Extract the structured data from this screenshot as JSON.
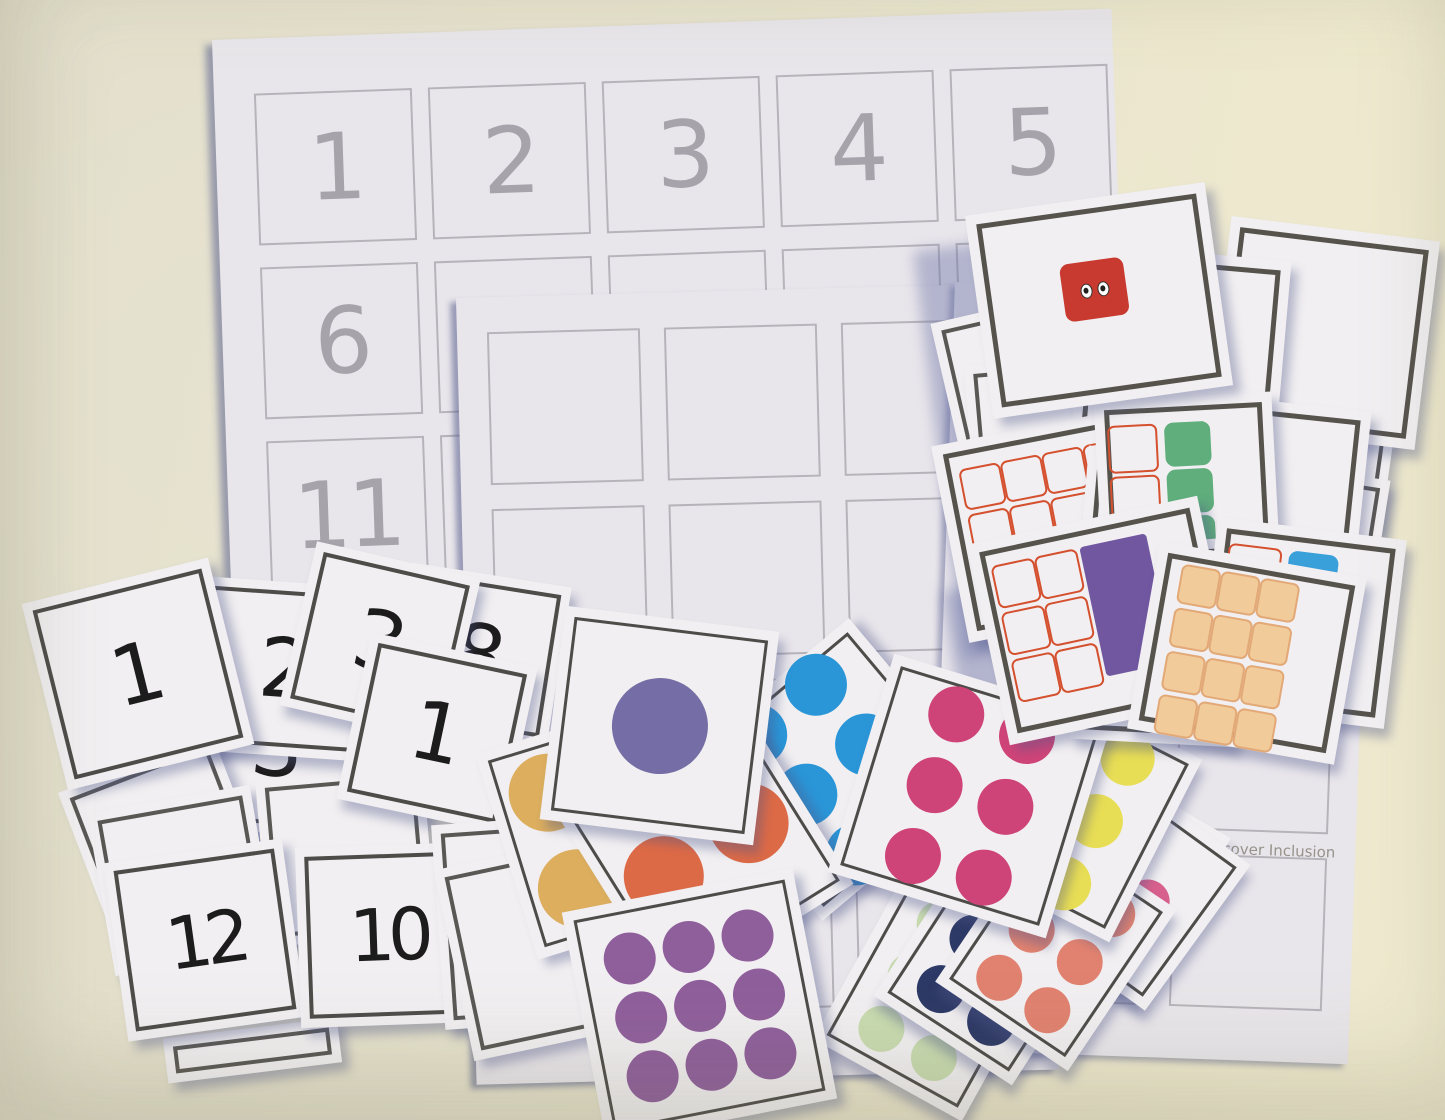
{
  "surface": {
    "background_color": "#e6e2cc"
  },
  "sheets": {
    "numbers": {
      "grid_numbers_row1": [
        "1",
        "2",
        "3",
        "4",
        "5"
      ],
      "grid_numbers_row2": [
        "6",
        "",
        "",
        "",
        ""
      ],
      "grid_numbers_row3": [
        "11",
        "",
        "",
        "",
        ""
      ]
    },
    "branded": {
      "watermark": "Discover Inclusion"
    }
  },
  "colors": {
    "paper": "#e9e6eb",
    "grid_line": "#b7b3ba",
    "sheet_number": "#a6a3ab",
    "card_border": "#4e4c49",
    "shadow_blue": "#6871a5"
  },
  "number_cards": {
    "big_one": "1",
    "two": "2",
    "three": "3",
    "eight": "8",
    "one_right": "1",
    "three_under": "3",
    "twelve": "12",
    "ten": "10"
  },
  "dot_cards": {
    "purple_one": {
      "count": 1,
      "cols": 1,
      "color": "#756da5",
      "size": 96,
      "gap": 0
    },
    "gold_three": {
      "count": 3,
      "cols": 2,
      "color": "#dcae5e",
      "size": 78,
      "gap": 22
    },
    "blue_six": {
      "count": 6,
      "cols": 2,
      "color": "#2a96d8",
      "size": 62,
      "gap": 16
    },
    "orange_two": {
      "count": 2,
      "cols": 2,
      "color": "#dd6a46",
      "size": 80,
      "gap": 20
    },
    "pink_six": {
      "count": 6,
      "cols": 2,
      "color": "#cf4478",
      "size": 56,
      "gap": 18
    },
    "yellow_six": {
      "count": 6,
      "cols": 2,
      "color": "#e8de55",
      "size": 54,
      "gap": 16
    },
    "periwinkle_four": {
      "count": 4,
      "cols": 2,
      "color": "#8289c3",
      "size": 54,
      "gap": 16
    },
    "plum_nine": {
      "count": 9,
      "cols": 3,
      "color": "#8f5f9c",
      "size": 52,
      "gap": 8
    },
    "green_six": {
      "count": 6,
      "cols": 2,
      "color": "#c9dbb0",
      "size": 46,
      "gap": 14
    },
    "navy_six": {
      "count": 6,
      "cols": 2,
      "color": "#2d3966",
      "size": 48,
      "gap": 12
    },
    "salmon_six": {
      "count": 6,
      "cols": 2,
      "color": "#e18270",
      "size": 46,
      "gap": 12
    },
    "rose_two": {
      "count": 2,
      "cols": 2,
      "color": "#d8608c",
      "size": 44,
      "gap": 12
    }
  },
  "block_cards": {
    "red_one": {
      "type": "single",
      "color": "#c8392f",
      "eyes": true,
      "w": 64,
      "h": 58
    },
    "orange_one": {
      "type": "single",
      "color": "#dc7b3c",
      "w": 40,
      "h": 96
    },
    "purple_two": {
      "type": "column",
      "count": 2,
      "color": "#5c3f90",
      "w": 44,
      "h": 54
    },
    "grey_column_a": {
      "type": "column",
      "count": 3,
      "color": "#87826f",
      "w": 40,
      "h": 48
    },
    "grey_column_b": {
      "type": "column",
      "count": 3,
      "color": "#87826f",
      "w": 40,
      "h": 48
    },
    "green_three": {
      "type": "frame-column",
      "rows": 3,
      "frame": "#d4502e",
      "color": "#5fae7c",
      "w": 46,
      "h": 44
    },
    "blue_four": {
      "type": "frame-column",
      "rows": 3,
      "frame": "#d4502e",
      "color": "#3aa0da",
      "w": 50,
      "h": 48
    },
    "red_tenframe_one": {
      "type": "tenframe",
      "rows": 3,
      "cols": 4,
      "cell": 38,
      "frame": "#d4502e",
      "fill_index": 7,
      "fill_color": "#cc4636",
      "eyes": true
    },
    "peach_ten": {
      "type": "tenframe",
      "rows": 4,
      "cols": 3,
      "cell": 36,
      "frame": "#e2a977",
      "fill_all": true,
      "fill_color": "#f2cb9b"
    },
    "purple_tenframe": {
      "type": "tenframe-right",
      "rows": 3,
      "cols": 2,
      "cell": 40,
      "frame": "#d4502e",
      "solid": "#7157a0"
    },
    "red_partial": {
      "type": "single",
      "color": "#d85840",
      "w": 46,
      "h": 42
    },
    "green_sliver": {
      "type": "single",
      "color": "#5fae7c",
      "w": 48,
      "h": 40
    }
  }
}
